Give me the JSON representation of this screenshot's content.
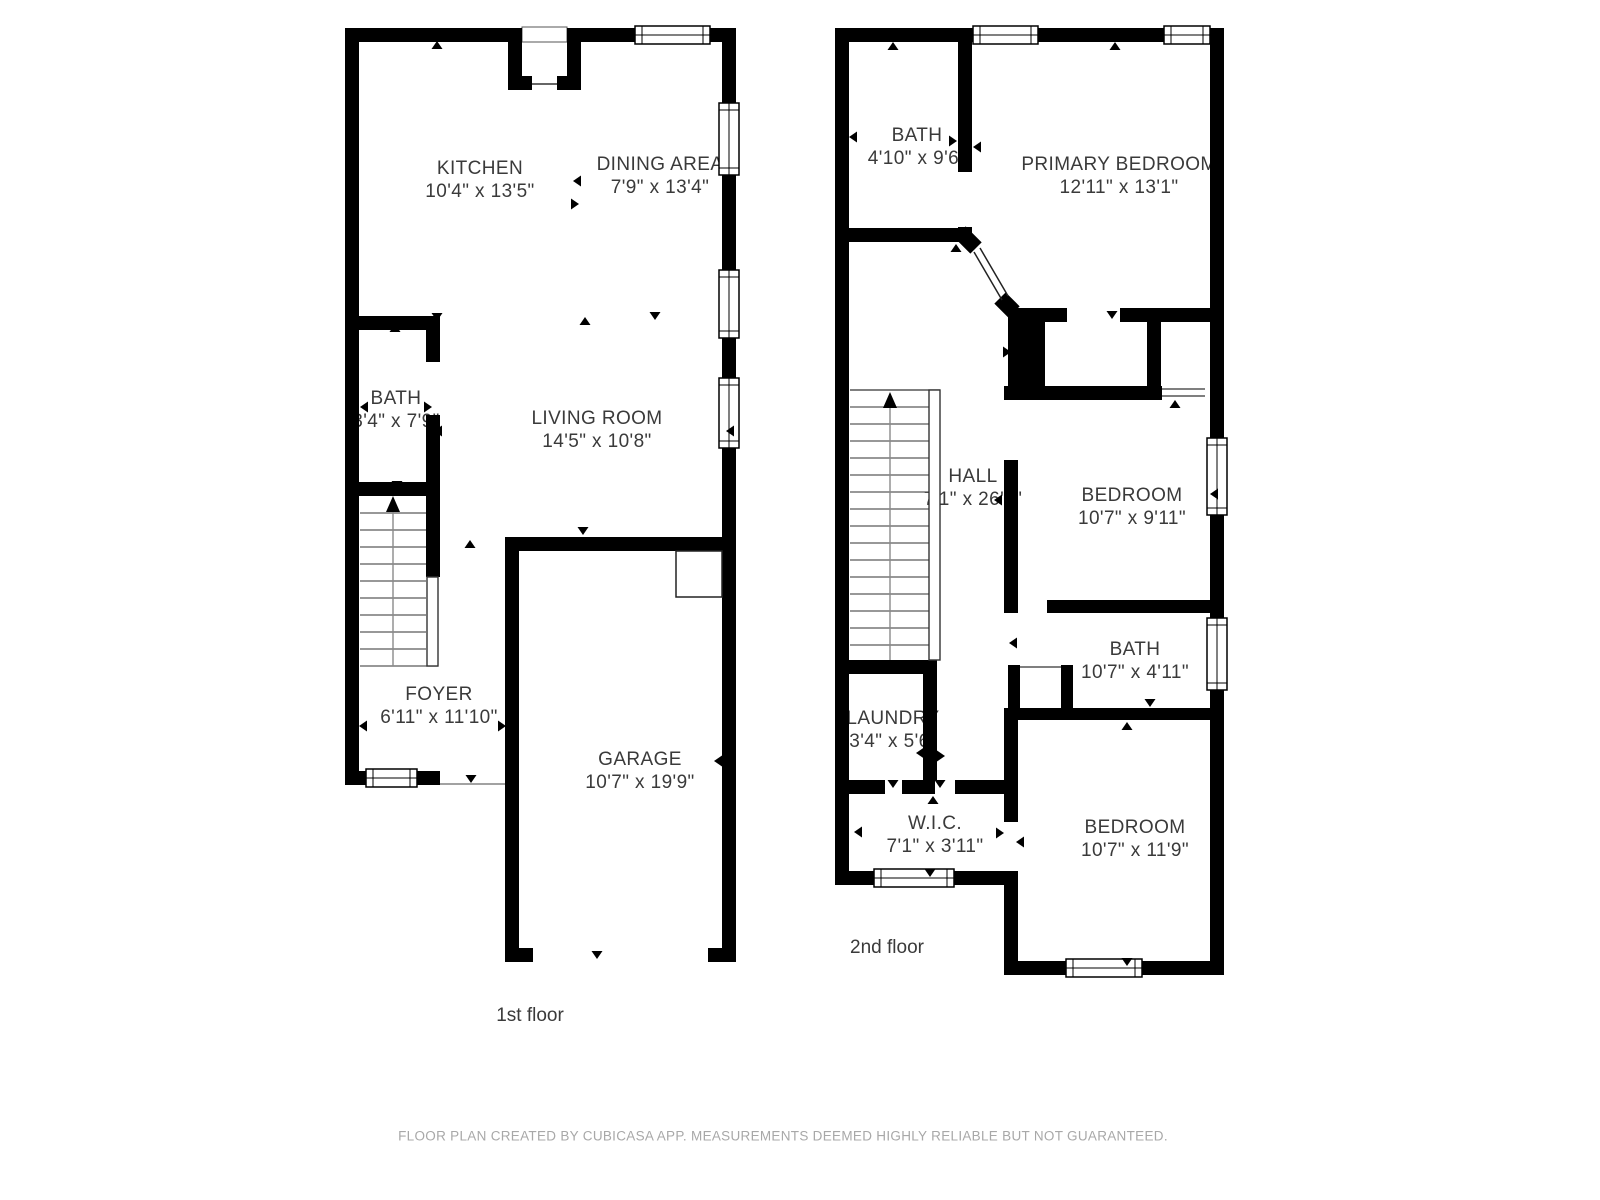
{
  "page": {
    "background": "#ffffff",
    "wall_color": "#000000",
    "label_color": "#3a3a3a",
    "footer_color": "#a8a8a8",
    "footer": "FLOOR PLAN CREATED BY CUBICASA APP. MEASUREMENTS DEEMED HIGHLY RELIABLE BUT NOT GUARANTEED."
  },
  "icons": {
    "stairs-up-arrow": "▲",
    "door-marker": "▲",
    "window-symbol": "▭"
  },
  "floors": [
    {
      "label": "1st floor",
      "rooms": [
        {
          "name": "KITCHEN",
          "dims": "10'4\" x 13'5\""
        },
        {
          "name": "DINING AREA",
          "dims": "7'9\" x 13'4\""
        },
        {
          "name": "BATH",
          "dims": "3'4\" x 7'9\""
        },
        {
          "name": "LIVING ROOM",
          "dims": "14'5\" x 10'8\""
        },
        {
          "name": "FOYER",
          "dims": "6'11\" x 11'10\""
        },
        {
          "name": "GARAGE",
          "dims": "10'7\" x 19'9\""
        }
      ]
    },
    {
      "label": "2nd floor",
      "rooms": [
        {
          "name": "BATH",
          "dims": "4'10\" x 9'6\""
        },
        {
          "name": "PRIMARY BEDROOM",
          "dims": "12'11\" x 13'1\""
        },
        {
          "name": "HALL",
          "dims": "7'1\" x 26'1\""
        },
        {
          "name": "BEDROOM",
          "dims": "10'7\" x 9'11\""
        },
        {
          "name": "BATH",
          "dims": "10'7\" x 4'11\""
        },
        {
          "name": "LAUNDRY",
          "dims": "3'4\" x 5'6\""
        },
        {
          "name": "W.I.C.",
          "dims": "7'1\" x 3'11\""
        },
        {
          "name": "BEDROOM",
          "dims": "10'7\" x 11'9\""
        }
      ]
    }
  ]
}
